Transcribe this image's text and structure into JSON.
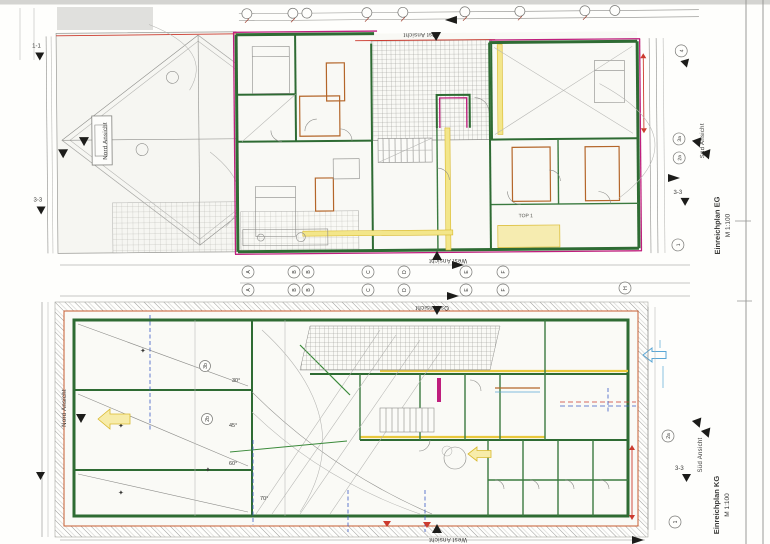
{
  "titles": {
    "eg_title": "Einreichplan EG",
    "eg_scale": "M 1:100",
    "kg_title": "Einreichplan KG",
    "kg_scale": "M 1:100"
  },
  "views": {
    "north": "Nord Ansicht",
    "east": "Ost Ansicht",
    "south": "Süd Ansicht",
    "west": "West Ansicht"
  },
  "sections": {
    "s11": "1-1",
    "s33": "3-3"
  },
  "grid_letters": [
    "A",
    "B",
    "B",
    "C",
    "D",
    "E",
    "F"
  ],
  "grid_letter_h": "H",
  "axis_marks": {
    "m4": "4",
    "m3a": "3a",
    "m2a": "2a",
    "m1": "1",
    "m3b": "3b",
    "m2b": "2b"
  },
  "angles": {
    "a30": "30°",
    "a45": "45°",
    "a60": "60°",
    "a70": "70°"
  },
  "room_labels": {
    "top1": "TOP 1"
  },
  "colors": {
    "wall_green": "#2e6b33",
    "outline_magenta": "#bf1e7d",
    "partition_orange": "#b4662a",
    "highlight_yellow": "#f3e68a",
    "dimension_red": "#cc3b2f",
    "section_blue": "#3b5bc4",
    "annotation_blue": "#5aa7d6"
  }
}
